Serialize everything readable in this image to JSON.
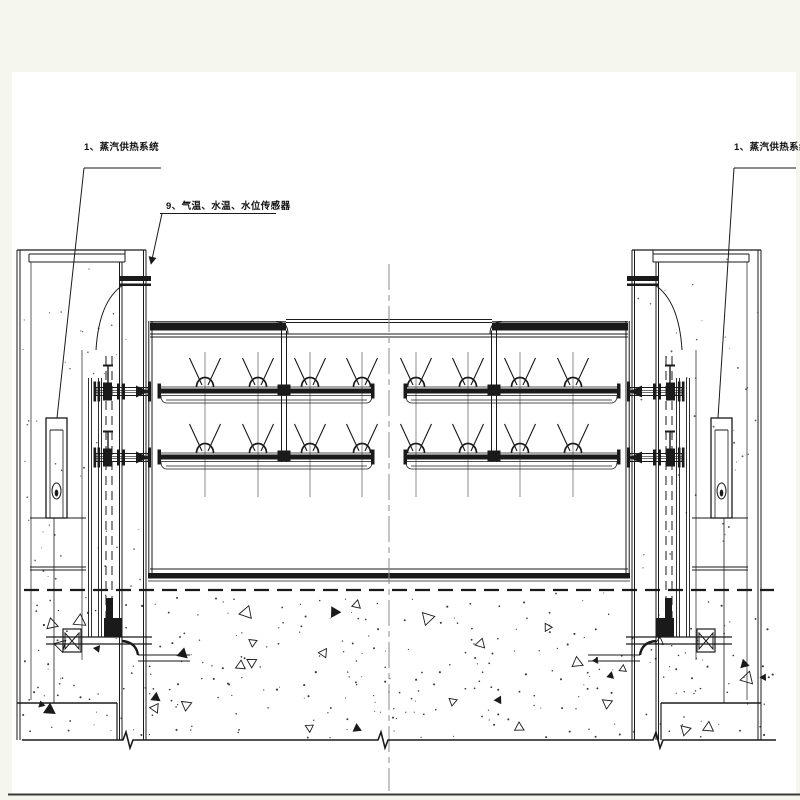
{
  "labels": {
    "steam_system_left": "1、蒸汽供热系统",
    "steam_system_right": "1、蒸汽供热系统",
    "sensors": "9、气温、水温、水位传感器"
  },
  "colors": {
    "ink": "#1a1a1a",
    "paper": "#ffffff",
    "margin": "#f5f7ef",
    "centerline": "#8a8a8a"
  }
}
